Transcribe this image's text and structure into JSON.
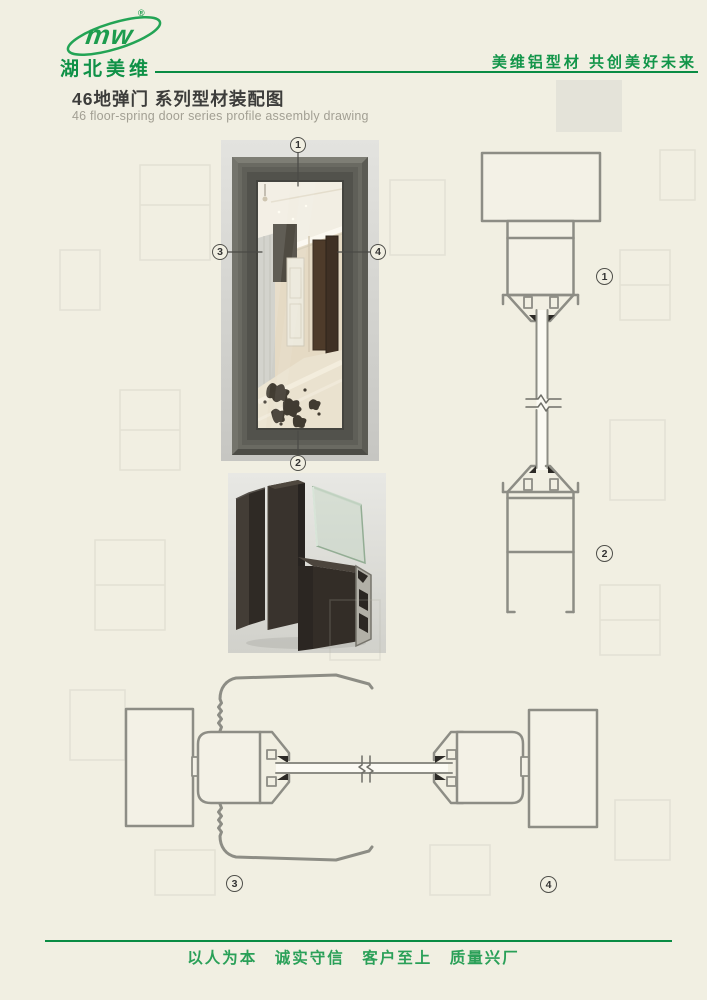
{
  "header": {
    "logo": {
      "text": "mw",
      "registered": "®",
      "company": "湖北美维"
    },
    "slogan": "美维铝型材 共创美好未来"
  },
  "title": {
    "cn": "46地弹门 系列型材装配图",
    "en": "46 floor-spring door series profile assembly drawing"
  },
  "callouts": {
    "c1": "1",
    "c2": "2",
    "c3": "3",
    "c4": "4"
  },
  "section_labels": {
    "s1": "1",
    "s2": "2",
    "s3": "3",
    "s4": "4"
  },
  "footer": {
    "motto": "以人为本　诚实守信　客户至上　质量兴厂"
  },
  "colors": {
    "brand_green": "#169549",
    "rule_green": "#0a8c44",
    "drawing_line": "#8d8d85",
    "paper": "#f1efe2"
  }
}
